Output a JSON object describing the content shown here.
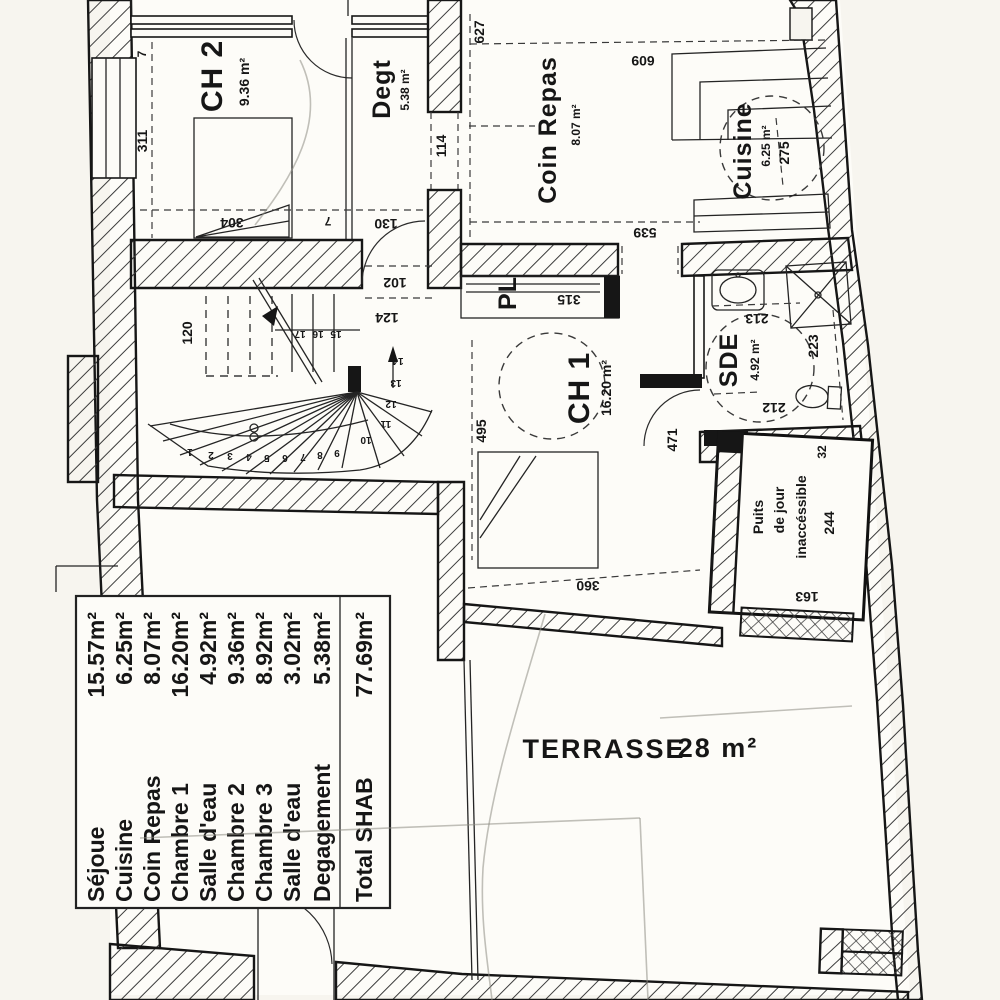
{
  "colors": {
    "ink": "#161616",
    "paper": "#f7f5ef",
    "room_fill": "#fdfcf8"
  },
  "rooms": {
    "ch2": {
      "name": "CH 2",
      "area": "9.36 m²"
    },
    "degt": {
      "name": "Degt",
      "area": "5.38 m²"
    },
    "coin_repas": {
      "name": "Coin Repas",
      "area": "8.07 m²"
    },
    "cuisine": {
      "name": "Cuisine",
      "area": "6.25 m²"
    },
    "ch1": {
      "name": "CH 1",
      "area": "16.20 m²"
    },
    "sde": {
      "name": "SDE",
      "area": "4.92 m²"
    },
    "pl": {
      "name": "PL"
    },
    "puits": {
      "line1": "Puits",
      "line2": "de jour",
      "line3": "inaccéssible"
    },
    "terrasse": {
      "name": "TERRASSE",
      "area": "28 m²"
    }
  },
  "dimensions": {
    "d627": "627",
    "d609": "609",
    "d539": "539",
    "d275": "275",
    "d311": "311",
    "d7_top": "7",
    "d114": "114",
    "d130": "130",
    "d102": "102",
    "d124": "124",
    "d120": "120",
    "d304": "304",
    "d7_mid": "7",
    "d315": "315",
    "d213": "213",
    "d223": "223",
    "d212": "212",
    "d471": "471",
    "d495": "495",
    "d360": "360",
    "d244": "244",
    "d163": "163",
    "d32": "32"
  },
  "stairs": {
    "numbers": [
      "1",
      "2",
      "3",
      "4",
      "5",
      "6",
      "7",
      "8",
      "9",
      "10",
      "11",
      "12",
      "13",
      "14",
      "15",
      "16",
      "17"
    ]
  },
  "legend": {
    "rows": [
      {
        "name": "Séjoue",
        "value": "15.57m²"
      },
      {
        "name": "Cuisine",
        "value": "6.25m²"
      },
      {
        "name": "Coin Repas",
        "value": "8.07m²"
      },
      {
        "name": "Chambre 1",
        "value": "16.20m²"
      },
      {
        "name": "Salle d'eau",
        "value": "4.92m²"
      },
      {
        "name": "Chambre 2",
        "value": "9.36m²"
      },
      {
        "name": "Chambre 3",
        "value": "8.92m²"
      },
      {
        "name": "Salle d'eau",
        "value": "3.02m²"
      },
      {
        "name": "Degagement",
        "value": "5.38m²"
      },
      {
        "name": "Total SHAB",
        "value": "77.69m²"
      }
    ]
  }
}
